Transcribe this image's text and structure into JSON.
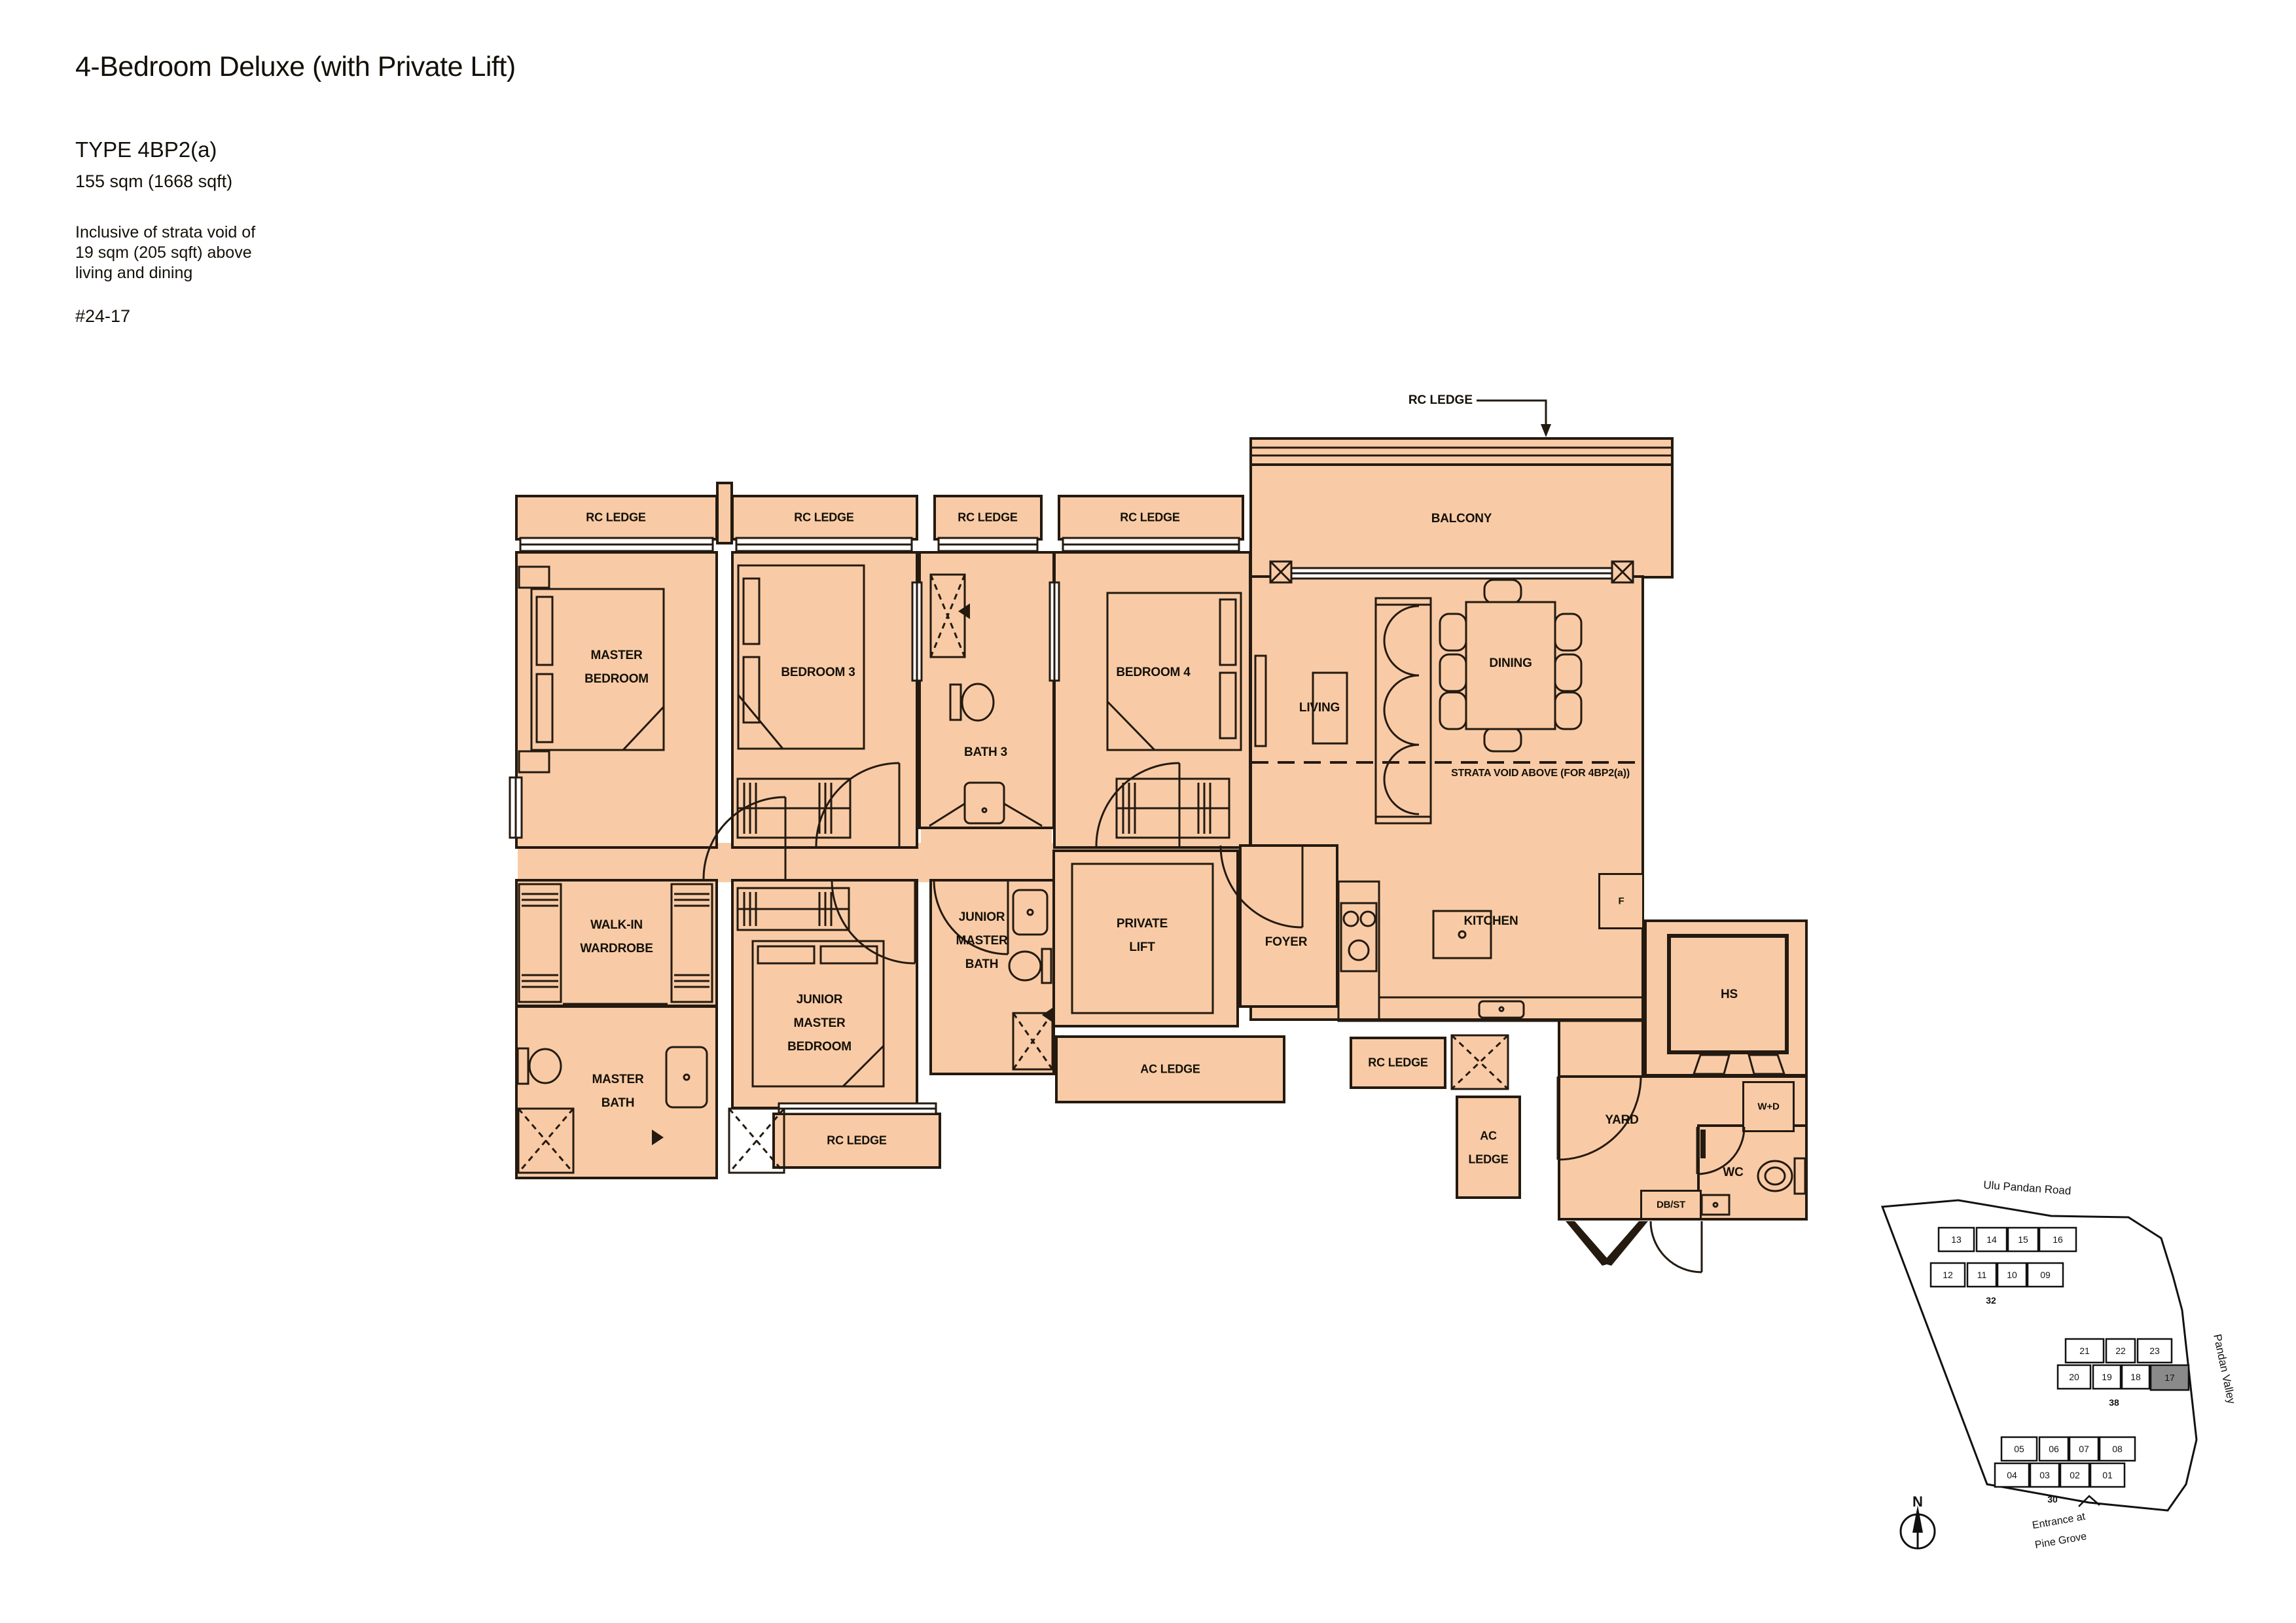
{
  "colors": {
    "room_fill": "#f8cba6",
    "wall": "#241a10",
    "highlight_block": "#8a8a8a"
  },
  "header": {
    "title": "4-Bedroom Deluxe (with Private Lift)",
    "type_label": "TYPE 4BP2(a)",
    "area": "155 sqm (1668 sqft)",
    "note_lines": [
      "Inclusive of strata void of",
      "19 sqm (205 sqft) above",
      "living and dining"
    ],
    "unit_number": "#24-17"
  },
  "plan": {
    "labels": {
      "rc_ledge": "RC LEDGE",
      "ac_ledge": "AC LEDGE",
      "ac_ledge_lines": [
        "AC",
        "LEDGE"
      ],
      "balcony": "BALCONY",
      "master_bedroom": [
        "MASTER",
        "BEDROOM"
      ],
      "bedroom3": "BEDROOM 3",
      "bedroom4": "BEDROOM 4",
      "bath3": "BATH 3",
      "living": "LIVING",
      "dining": "DINING",
      "walk_in_wardrobe": [
        "WALK-IN",
        "WARDROBE"
      ],
      "master_bath": [
        "MASTER",
        "BATH"
      ],
      "junior_master_bedroom": [
        "JUNIOR",
        "MASTER",
        "BEDROOM"
      ],
      "junior_master_bath": [
        "JUNIOR",
        "MASTER",
        "BATH"
      ],
      "private_lift": [
        "PRIVATE",
        "LIFT"
      ],
      "foyer": "FOYER",
      "kitchen": "KITCHEN",
      "yard": "YARD",
      "hs": "HS",
      "wc": "WC",
      "wd": "W+D",
      "db_st": "DB/ST",
      "fridge": "F",
      "strata_void": "STRATA VOID ABOVE (FOR 4BP2(a))"
    }
  },
  "sitemap": {
    "road": "Ulu Pandan Road",
    "valley": "Pandan Valley",
    "entrance_lines": [
      "Entrance at",
      "Pine Grove"
    ],
    "north": "N",
    "highlighted_unit": "17",
    "clusters": [
      {
        "label": "32",
        "row1": [
          "13",
          "14",
          "15",
          "16"
        ],
        "row2": [
          "12",
          "11",
          "10",
          "09"
        ]
      },
      {
        "label": "38",
        "row1": [
          "21",
          "22",
          "23"
        ],
        "row2": [
          "20",
          "19",
          "18",
          "17"
        ]
      },
      {
        "label": "30",
        "row1": [
          "05",
          "06",
          "07",
          "08"
        ],
        "row2": [
          "04",
          "03",
          "02",
          "01"
        ]
      }
    ]
  }
}
